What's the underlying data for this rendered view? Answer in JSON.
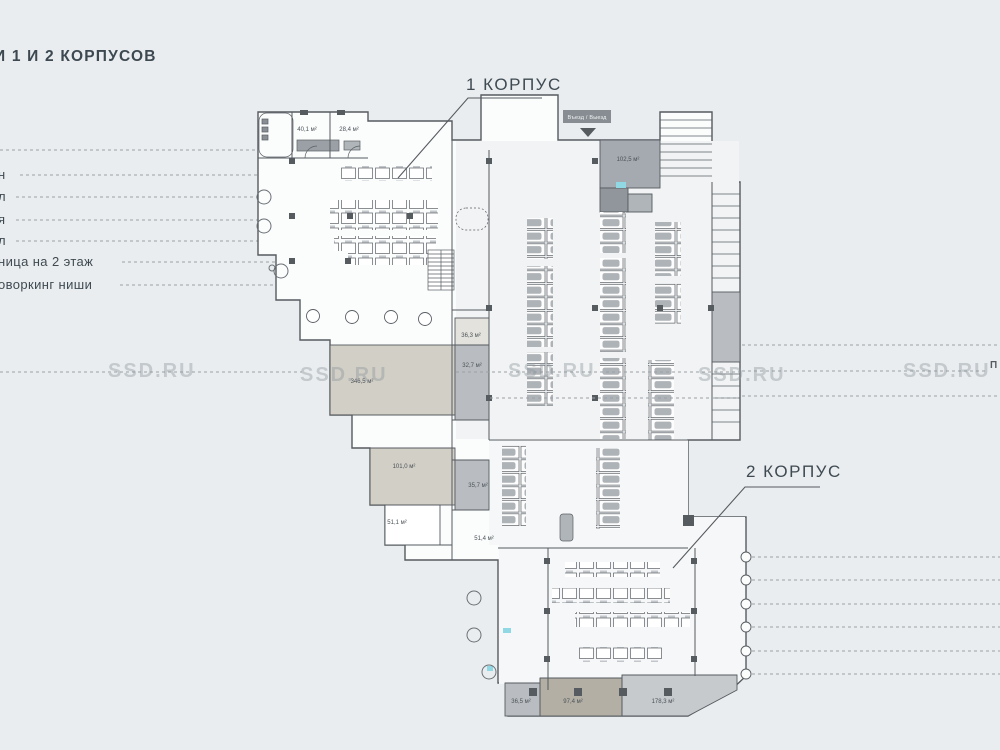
{
  "title": "И 1 И 2 КОРПУСОВ",
  "legend": {
    "items": [
      {
        "label": "н"
      },
      {
        "label": "л"
      },
      {
        "label": "я"
      },
      {
        "label": "л"
      },
      {
        "label": "ница на 2 этаж"
      },
      {
        "label": "оворкинг ниши"
      }
    ]
  },
  "plan": {
    "building1_label": "1 КОРПУС",
    "building2_label": "2 КОРПУС",
    "entrance_label": "Въезд / Выезд",
    "edge_partial_label": "П",
    "rooms": [
      {
        "area": "40,1 м²"
      },
      {
        "area": "28,4 м²"
      },
      {
        "area": "102,5 м²"
      },
      {
        "area": "36,3 м²"
      },
      {
        "area": "32,7 м²"
      },
      {
        "area": "346,5 м²"
      },
      {
        "area": "101,0 м²"
      },
      {
        "area": "35,7 м²"
      },
      {
        "area": "51,1 м²"
      },
      {
        "area": "51,4 м²"
      },
      {
        "area": "36,5 м²"
      },
      {
        "area": "97,4 м²"
      },
      {
        "area": "178,3 м²"
      }
    ]
  },
  "watermark": {
    "text": "SSD.RU"
  },
  "colors": {
    "background": "#e9edef",
    "wall": "#565b60",
    "beige_room": "#c8c3b8",
    "gray_room": "#b9bdc1",
    "dark_room": "#9aa0a6",
    "teal_accent": "#8fd8e4",
    "text": "#3f4a52",
    "watermark": "#98a0a6"
  }
}
